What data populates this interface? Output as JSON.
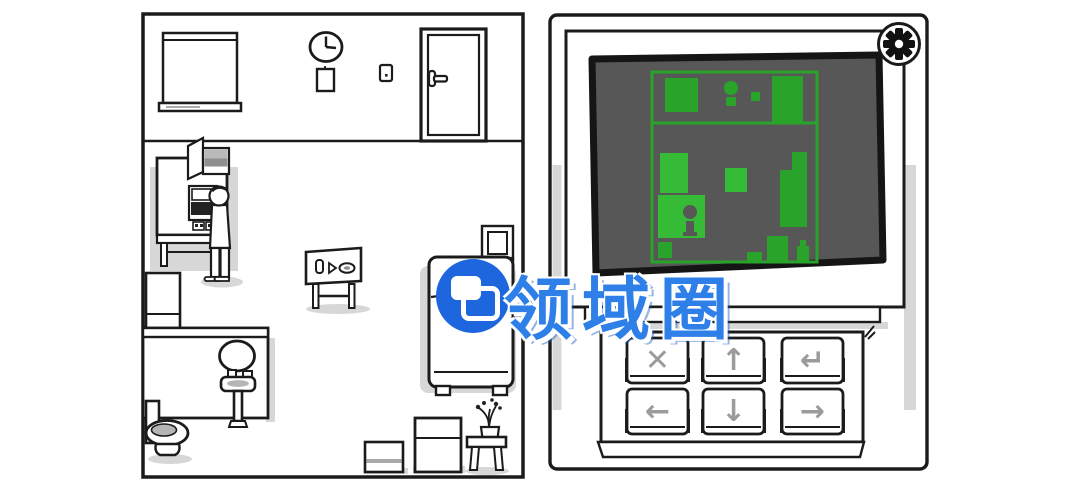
{
  "watermark": {
    "text": "领域圈",
    "logo_icon": "overlapping-windows"
  },
  "right_panel": {
    "settings_icon": "gear",
    "keypad": {
      "keys": [
        {
          "name": "cancel",
          "symbol": "✕"
        },
        {
          "name": "up",
          "symbol": "↑"
        },
        {
          "name": "enter",
          "symbol": "↵"
        },
        {
          "name": "left",
          "symbol": "←"
        },
        {
          "name": "down",
          "symbol": "↓"
        },
        {
          "name": "right",
          "symbol": "→"
        }
      ]
    },
    "screen": {
      "content": "green floor-plan map of the room"
    }
  },
  "colors": {
    "ink": "#1b1b1b",
    "screen_gray": "#575757",
    "map_green": "#2aa32a",
    "map_green_bright": "#36bb36",
    "key_symbol": "#9b9b9b",
    "shadow": "#c9c9c9",
    "watermark_blue": "#2e7fe8",
    "logo_blue": "#1d66dd"
  }
}
